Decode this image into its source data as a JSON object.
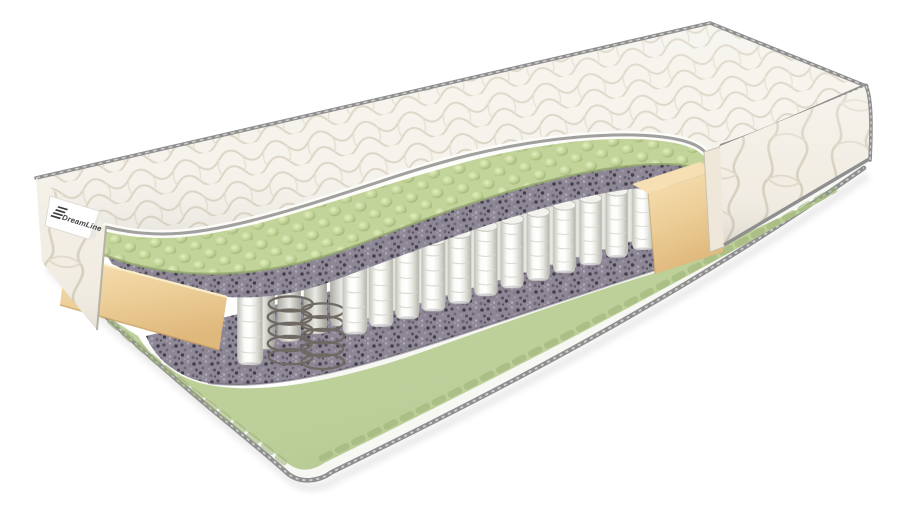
{
  "image": {
    "type": "product-illustration",
    "subject": "mattress cutaway showing internal layers",
    "background": "#ffffff"
  },
  "brand": {
    "label": "DreamLine"
  },
  "colors": {
    "background": "#ffffff",
    "quilt_top": "#f6f3ec",
    "quilt_side": "#f1ede3",
    "quilt_stitch": "#d9d2c2",
    "piping": "#8f8f8f",
    "piping_light": "#cfcfcf",
    "egg_foam": "#c3d49b",
    "egg_foam_shadow": "#93a86f",
    "coir": "#8e8795",
    "coir_dark": "#4c4654",
    "spring": "#f3f3ee",
    "spring_shade": "#b7b7af",
    "side_foam": "#f0d6a4",
    "side_foam_shadow": "#dfb87c",
    "base_foam": "#bccf97",
    "base_foam_shadow": "#9db077",
    "base_fabric": "#f7f7f4",
    "wire": "#6e6963",
    "tag": "#ffffff",
    "brand_text": "#3d3d3d"
  }
}
